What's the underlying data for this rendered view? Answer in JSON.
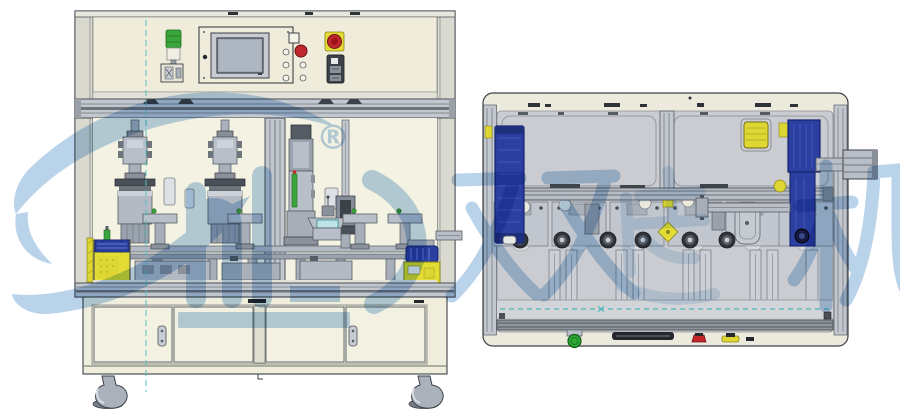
{
  "drawing": {
    "type": "machine-cad-two-views",
    "views": [
      "front-elevation",
      "top-plan"
    ]
  },
  "watermark": {
    "registered_symbol": "®",
    "characters": [
      "双",
      "达",
      "机"
    ],
    "color": "#b0cde9"
  },
  "colors": {
    "panel_cream": "#efecdc",
    "window_cream": "#f4f2e3",
    "frame_aluminum": "#c3c8ce",
    "outline_dark": "#3c4147",
    "interior_gray": "#caccd1",
    "machinery_gray": "#b3bac4",
    "motor_blue": "#2a3f9f",
    "accent_yellow": "#e3dc35",
    "signal_green": "#3aa53a",
    "button_red": "#c5262b",
    "centerline_teal": "#54bfbf",
    "background": "#ffffff"
  }
}
